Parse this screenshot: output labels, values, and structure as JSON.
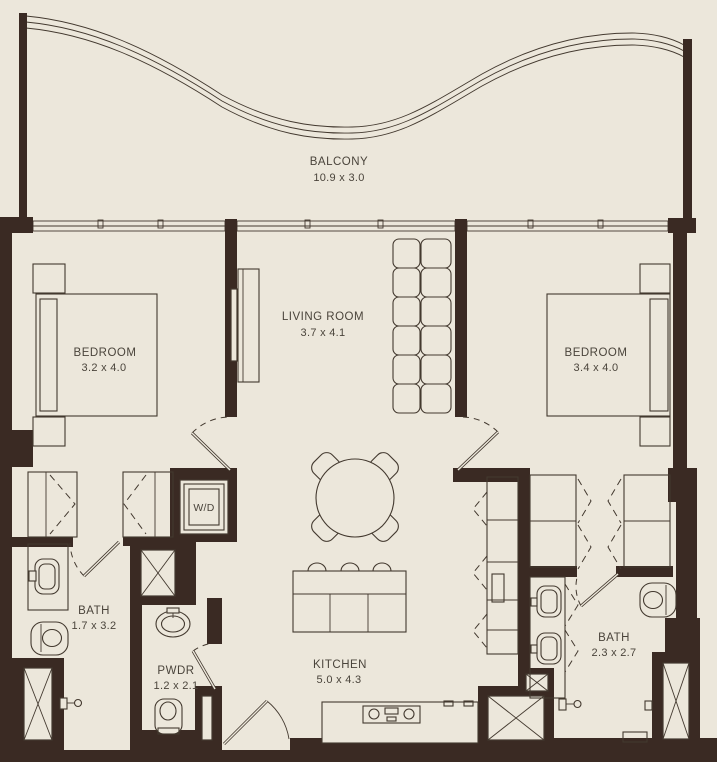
{
  "plan": {
    "colors": {
      "background": "#ece7db",
      "wall": "#3a2a23",
      "line": "#43392f",
      "text": "#4a443b"
    },
    "balcony": {
      "name": "BALCONY",
      "dims": "10.9 x 3.0"
    },
    "rooms": {
      "bedroom_left": {
        "name": "BEDROOM",
        "dims": "3.2 x 4.0"
      },
      "living": {
        "name": "LIVING ROOM",
        "dims": "3.7 x 4.1"
      },
      "bedroom_right": {
        "name": "BEDROOM",
        "dims": "3.4 x 4.0"
      },
      "bath_left": {
        "name": "BATH",
        "dims": "1.7 x 3.2"
      },
      "powder": {
        "name": "PWDR",
        "dims": "1.2 x 2.1"
      },
      "kitchen": {
        "name": "KITCHEN",
        "dims": "5.0 x 4.3"
      },
      "bath_right": {
        "name": "BATH",
        "dims": "2.3 x 2.7"
      }
    },
    "labels": {
      "washer_dryer": "W/D"
    }
  }
}
